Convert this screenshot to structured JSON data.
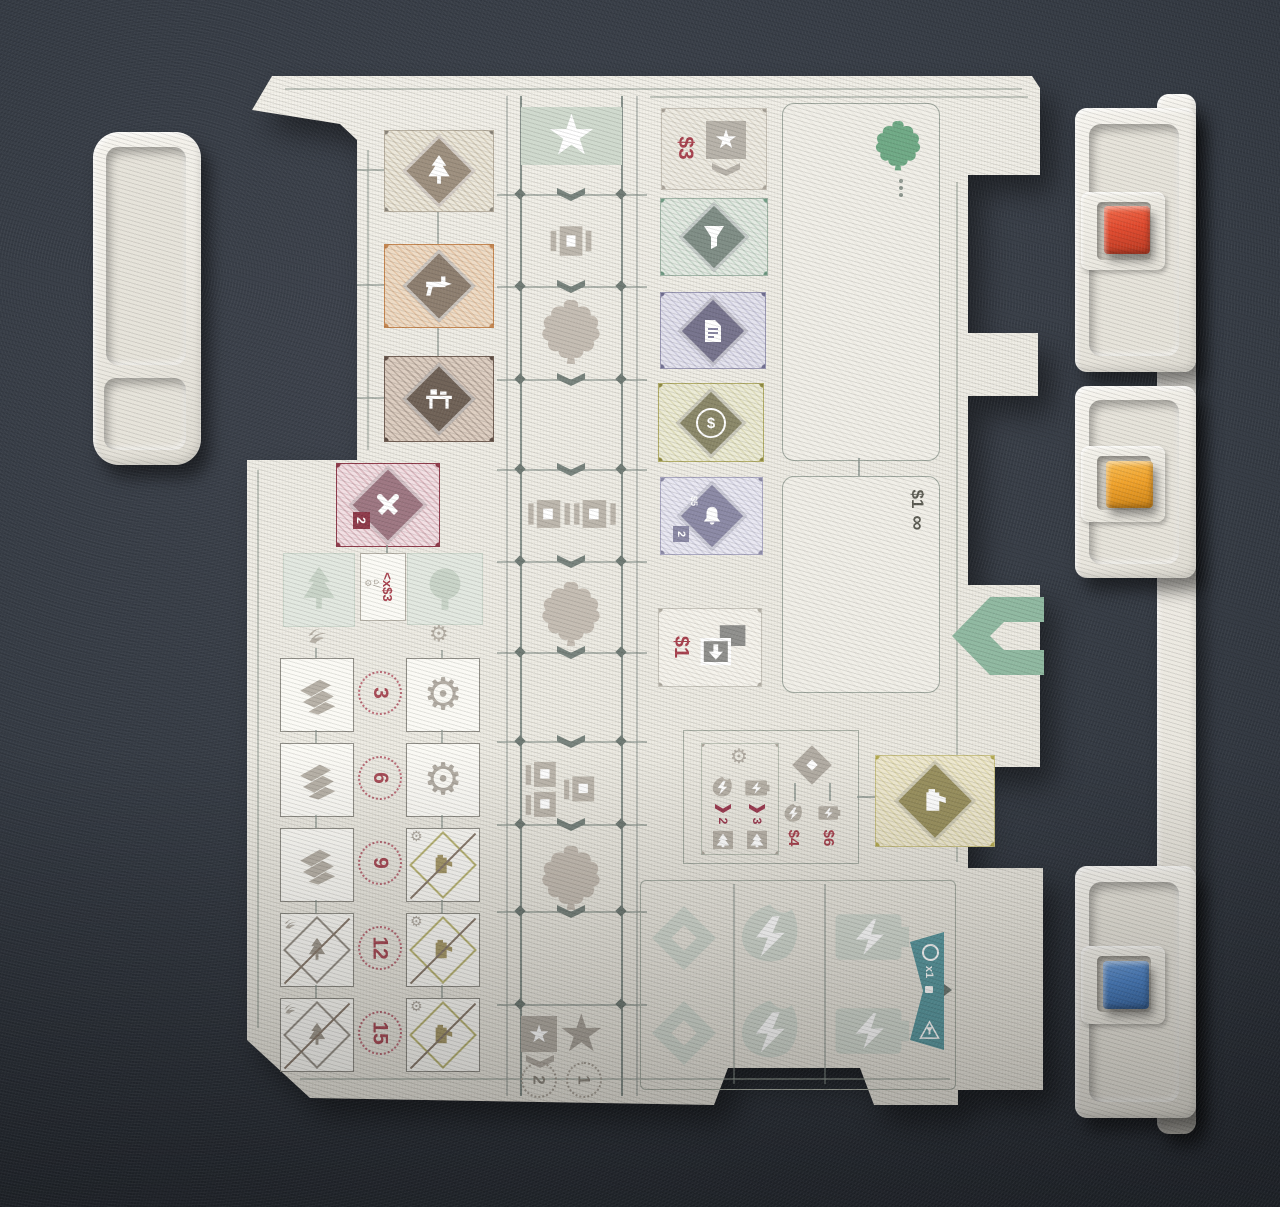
{
  "scene": {
    "description": "Photograph of a white game player board on dark gray foam, with a white plastic tray at left and a white plastic rail holding red, orange and blue cubes at right",
    "foam_color": "#343a43",
    "board_color": "#f0eee7",
    "plastic_color": "#eeebe3",
    "accents": {
      "teal": "#5b99a0",
      "green_arrow": "#8fb8a0",
      "wine": "#8e3a4a",
      "red_text": "#a8414e",
      "gold": "#b3a94f"
    }
  },
  "glyphs": {
    "gear": "⚙",
    "star": "★",
    "infinity": "∞",
    "dollar": "$",
    "sell_icons": "⌂/⚙"
  },
  "labels": {
    "market_price": "$3",
    "bell_price": "$5",
    "bell_badge": "2",
    "deck_price": "$1",
    "discard_price": "$1",
    "sell_label": "<x$3",
    "craft_badge": "2",
    "wreath_values": [
      "3",
      "6",
      "9",
      "12",
      "15"
    ],
    "convert_counts": [
      "2",
      "3"
    ],
    "convert_prices": [
      "$4",
      "$6"
    ],
    "score_square_star": "2",
    "score_star": "1",
    "banner_multiplier": "x1"
  },
  "board": {
    "track_cells": [
      "star",
      "domino x1",
      "gnome",
      "blank",
      "domino x2",
      "gnome",
      "blank",
      "domino x4",
      "gnome",
      "scoring"
    ],
    "upper_tiles": [
      "pine-tree diamond",
      "drill diamond",
      "workbench diamond"
    ],
    "market_tiles": [
      "star card $3",
      "funnel",
      "document",
      "coin",
      "bell badge 2",
      "discard $1"
    ],
    "workshop_rows": [
      {
        "left": "wood-pile",
        "right": "gear"
      },
      {
        "left": "wood-pile",
        "right": "gear"
      },
      {
        "left": "wood-pile",
        "right": "workshop-crossed"
      },
      {
        "left": "tree-crossed",
        "right": "workshop-crossed"
      },
      {
        "left": "tree-crossed",
        "right": "workshop-crossed"
      }
    ]
  },
  "components": {
    "tray": {
      "name": "white plastic tray with two recesses"
    },
    "rail": {
      "name": "white plastic rail with three cube slots",
      "cubes": [
        {
          "name": "red cube",
          "color": "#e04a2e"
        },
        {
          "name": "orange cube",
          "color": "#f0a22b"
        },
        {
          "name": "blue cube",
          "color": "#4b80c2"
        }
      ]
    }
  }
}
